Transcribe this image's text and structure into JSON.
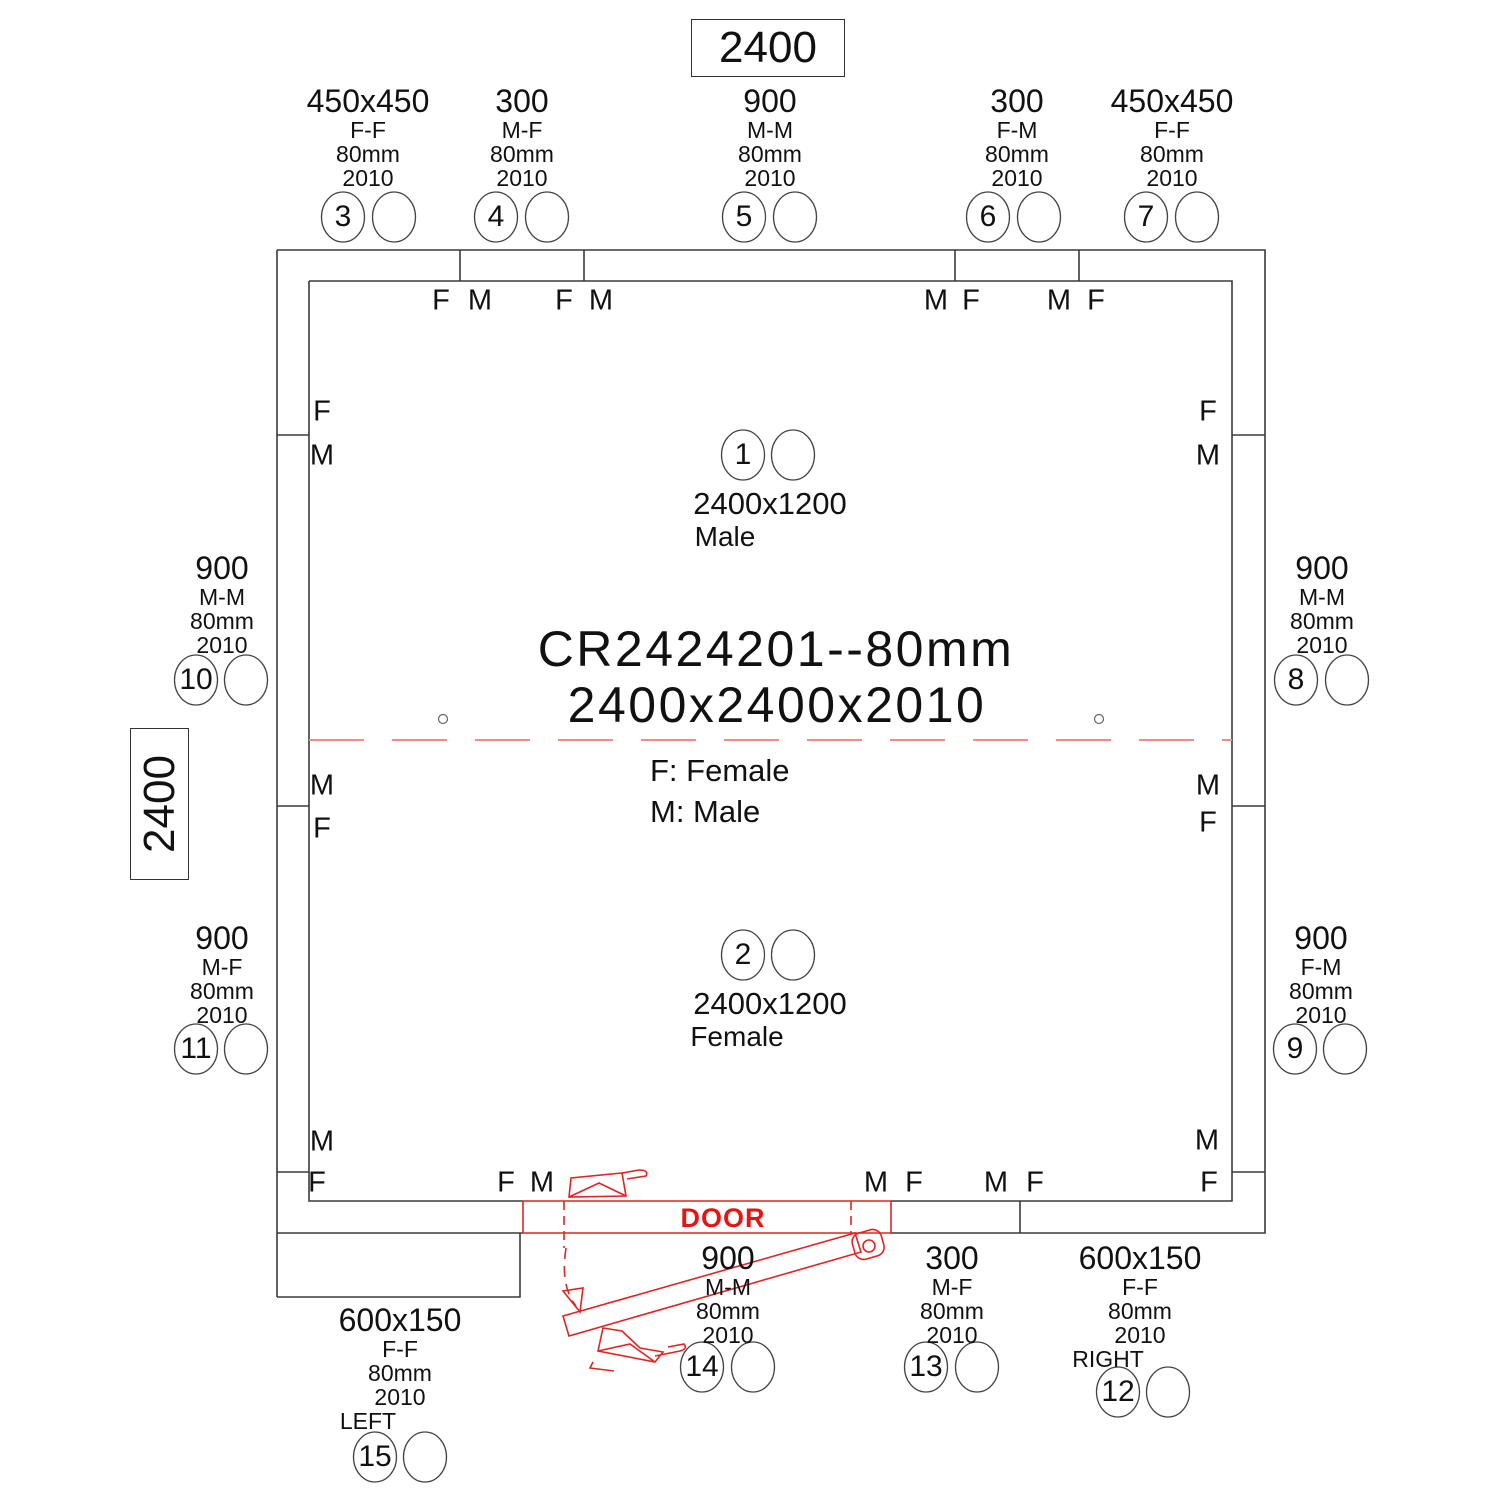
{
  "colors": {
    "line": "#3a3a3a",
    "door_red": "#e02424",
    "ceiling_joint_dash": "#f48a8a",
    "door_text": "#e81414"
  },
  "dimensions": {
    "top": "2400",
    "left": "2400"
  },
  "title": {
    "model": "CR2424201--80mm",
    "size": "2400x2400x2010"
  },
  "legend": {
    "female": "F: Female",
    "male": "M: Male"
  },
  "door": {
    "label": "DOOR"
  },
  "ceiling_panels": {
    "c1": {
      "num": "1",
      "size": "2400x1200",
      "gender": "Male"
    },
    "c2": {
      "num": "2",
      "size": "2400x1200",
      "gender": "Female"
    }
  },
  "panels": {
    "p3": {
      "num": "3",
      "size": "450x450",
      "joint": "F-F",
      "thickness": "80mm",
      "height": "2010"
    },
    "p4": {
      "num": "4",
      "size": "300",
      "joint": "M-F",
      "thickness": "80mm",
      "height": "2010"
    },
    "p5": {
      "num": "5",
      "size": "900",
      "joint": "M-M",
      "thickness": "80mm",
      "height": "2010"
    },
    "p6": {
      "num": "6",
      "size": "300",
      "joint": "F-M",
      "thickness": "80mm",
      "height": "2010"
    },
    "p7": {
      "num": "7",
      "size": "450x450",
      "joint": "F-F",
      "thickness": "80mm",
      "height": "2010"
    },
    "p8": {
      "num": "8",
      "size": "900",
      "joint": "M-M",
      "thickness": "80mm",
      "height": "2010"
    },
    "p9": {
      "num": "9",
      "size": "900",
      "joint": "F-M",
      "thickness": "80mm",
      "height": "2010"
    },
    "p10": {
      "num": "10",
      "size": "900",
      "joint": "M-M",
      "thickness": "80mm",
      "height": "2010"
    },
    "p11": {
      "num": "11",
      "size": "900",
      "joint": "M-F",
      "thickness": "80mm",
      "height": "2010"
    },
    "p12": {
      "num": "12",
      "size": "600x150",
      "joint": "F-F",
      "thickness": "80mm",
      "height": "2010",
      "side": "RIGHT"
    },
    "p13": {
      "num": "13",
      "size": "300",
      "joint": "M-F",
      "thickness": "80mm",
      "height": "2010"
    },
    "p14": {
      "num": "14",
      "size": "900",
      "joint": "M-M",
      "thickness": "80mm",
      "height": "2010"
    },
    "p15": {
      "num": "15",
      "size": "600x150",
      "joint": "F-F",
      "thickness": "80mm",
      "height": "2010",
      "side": "LEFT"
    }
  },
  "wall_letters": {
    "top": [
      "F",
      "M",
      "F",
      "M",
      "M",
      "F",
      "M",
      "F"
    ],
    "bottom": [
      "F",
      "F",
      "M",
      "M",
      "F",
      "M",
      "F",
      "F"
    ],
    "left": [
      "F",
      "M",
      "M",
      "F",
      "M"
    ],
    "right": [
      "F",
      "M",
      "M",
      "F",
      "M"
    ]
  }
}
